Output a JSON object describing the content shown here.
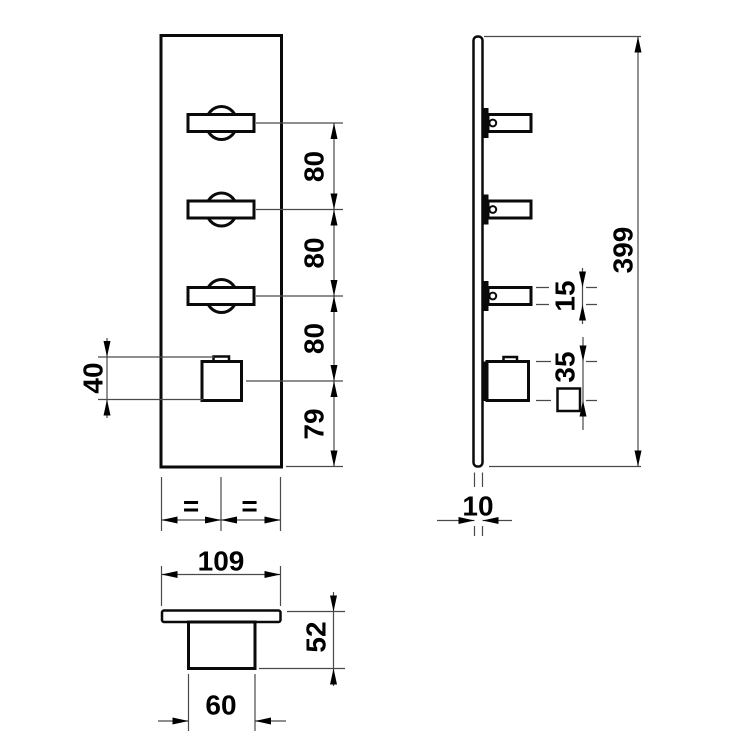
{
  "colors": {
    "ink": "#000000",
    "outline": "#0a0a0a",
    "thin_line": "#4a4a4a",
    "background": "#ffffff"
  },
  "front_view": {
    "labels": {
      "seg1": "80",
      "seg2": "80",
      "seg3": "80",
      "seg4": "79",
      "knob_height": "40",
      "equal_left": "=",
      "equal_right": "="
    }
  },
  "side_view": {
    "labels": {
      "overall_height": "399",
      "handle_thickness": "15",
      "knob_thickness": "35",
      "plate_thickness": "10"
    }
  },
  "bottom_view": {
    "labels": {
      "plate_width": "109",
      "overall_depth": "52",
      "knob_width": "60"
    }
  }
}
